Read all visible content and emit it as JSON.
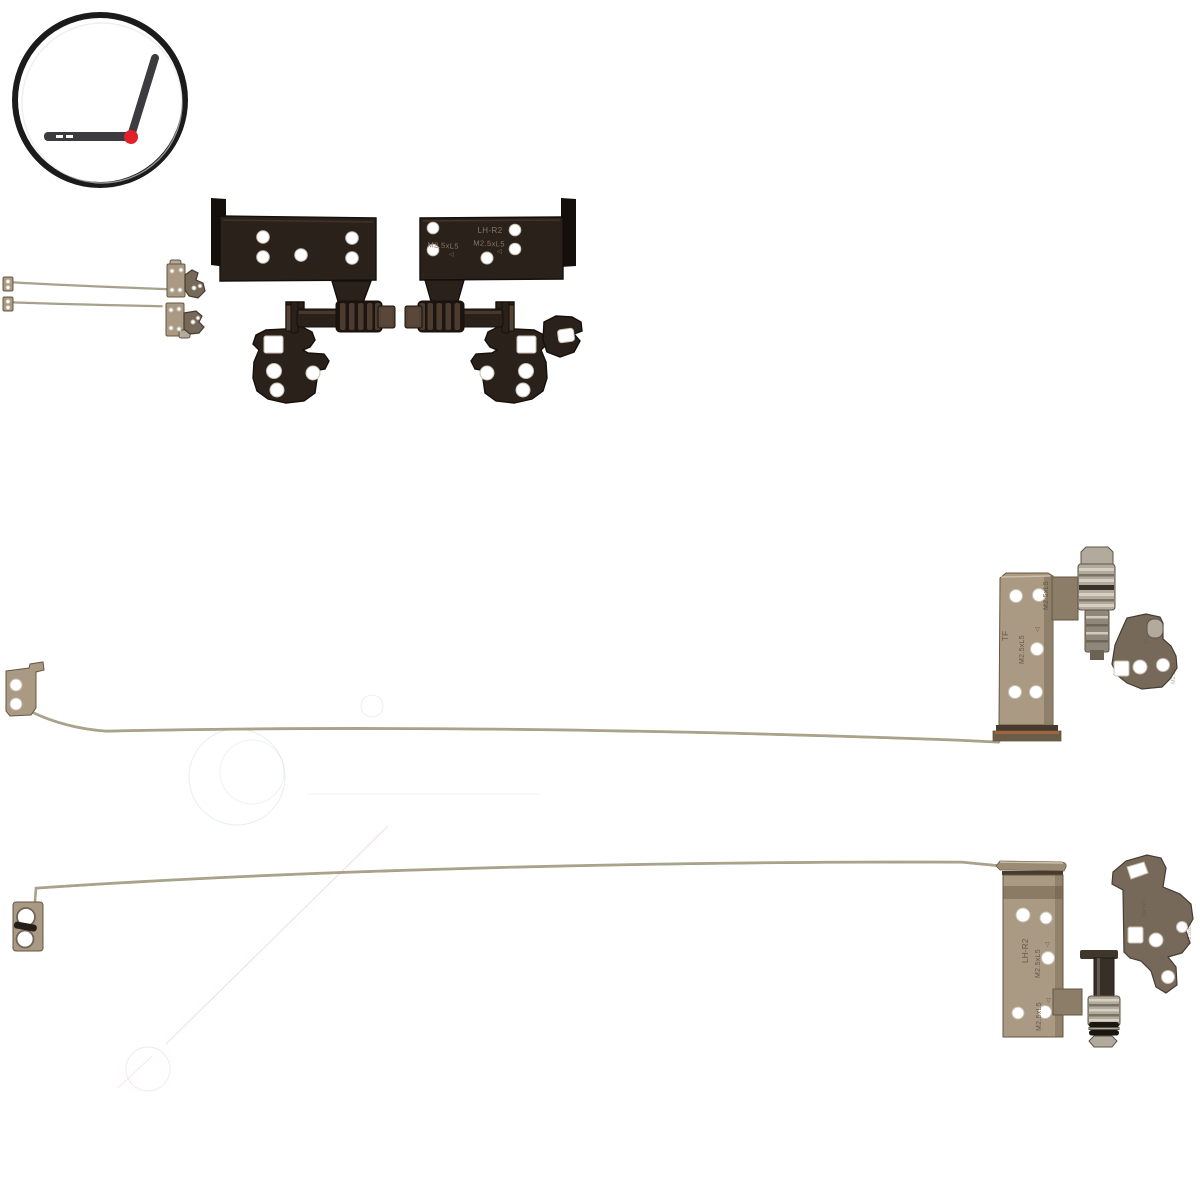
{
  "window": {
    "width": 1200,
    "height": 1200,
    "background": "#ffffff"
  },
  "palette": {
    "background": "#ffffff",
    "logo_ring": "#1b1b1b",
    "logo_laptop": "#3b3b40",
    "logo_hinge_dot": "#e02128",
    "dark_metal": "#2b211b",
    "dark_metal_light": "#554335",
    "dark_metal_edge": "#150f0b",
    "tan_metal": "#aa9a83",
    "tan_metal_light": "#d5c8b1",
    "tan_metal_edge": "#655741",
    "neck_tan": "#8c7d68",
    "lip_dark": "#463b2e",
    "lip_orange": "#a8663a",
    "rail_metal": "#aaa38b",
    "rail_edge": "#6f6955",
    "silver_metal": "#b2aa9c",
    "silver_light": "#ddd6c8",
    "silver_dark": "#5c5444",
    "rubber_black": "#1a1611",
    "arm_metal": "#77695a",
    "arm_light": "#a29584",
    "arm_edge": "#463c31",
    "stamp_on_dark": "#8d7a66",
    "stamp_on_tan": "#55483a",
    "hole_ring": "#c8c0b2",
    "hole_ring_dark": "#6f6455",
    "watermark_pink": "#e5c6cb",
    "watermark_blue": "#cdd8e4"
  },
  "logo": {
    "icon": "open-laptop-with-hinge-dot-in-circle"
  },
  "stamps": {
    "top_right_hinge": {
      "model": "LH-R2",
      "screw_spec_left": "M2.5xL5",
      "screw_spec_center": "M2.5xL5",
      "triangle_left": "◁",
      "triangle_center": "◁"
    },
    "middle_rail": {
      "plate_mark": "TF",
      "plate_screw_spec_a": "M2.5xL5",
      "plate_screw_spec_b": "M2.5xL5",
      "plate_triangle": "◁",
      "arm_triangle": "△",
      "arm_screw_spec": "M2.5xL3"
    },
    "bottom_rail": {
      "plate_model": "LH-R2",
      "plate_screw_spec_a": "M2.5xL5",
      "plate_screw_spec_b": "M2.5xL5",
      "plate_triangle_a": "◁",
      "plate_triangle_b": "◁",
      "arm_model": "LH-R2",
      "arm_screw_spec": "M2.5xL3",
      "arm_triangle": "◁"
    }
  }
}
